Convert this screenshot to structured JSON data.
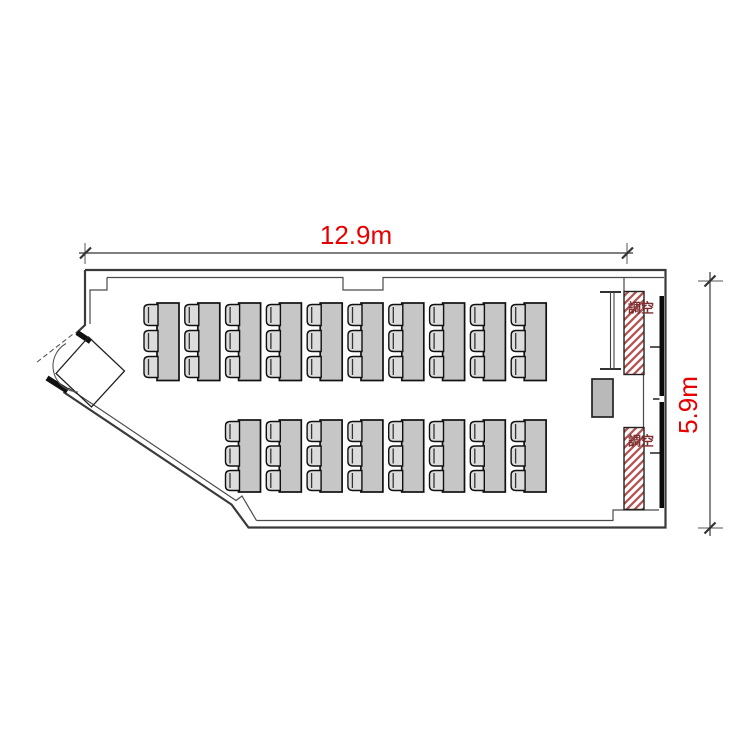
{
  "plan": {
    "dimension_width_label": "12.9m",
    "dimension_height_label": "5.9m",
    "ac_label_top": "空調",
    "ac_label_bottom": "空調"
  },
  "furniture": {
    "rows": [
      {
        "name": "top-row",
        "tables": 10,
        "seats_per_table": 3
      },
      {
        "name": "bottom-row",
        "tables": 8,
        "seats_per_table": 3
      }
    ]
  },
  "colors": {
    "dimension_text": "#e60000",
    "hatch": "#b25555",
    "wall": "#3a3a3a",
    "table_fill": "#c6c6c6",
    "chair_fill": "#dcdcdc",
    "ac_text": "#7d2f2f"
  }
}
